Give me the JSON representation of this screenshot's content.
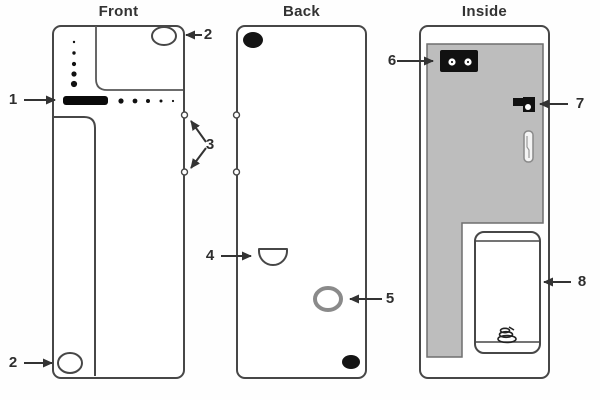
{
  "figure": {
    "type": "device-parts-diagram",
    "views": {
      "front": {
        "title": "Front"
      },
      "back": {
        "title": "Back"
      },
      "inside": {
        "title": "Inside"
      }
    },
    "callouts": {
      "c1": "1",
      "c2": "2",
      "c3": "3",
      "c4": "4",
      "c5": "5",
      "c6": "6",
      "c7": "7",
      "c8": "8"
    },
    "colors": {
      "outline": "#474747",
      "arrow": "#333333",
      "black_fill": "#111111",
      "inner_gray_fill": "#bdbdbd",
      "gray_ring": "#8a8a8a",
      "background": "#fefefe",
      "label_text": "#2e2e2e"
    }
  }
}
